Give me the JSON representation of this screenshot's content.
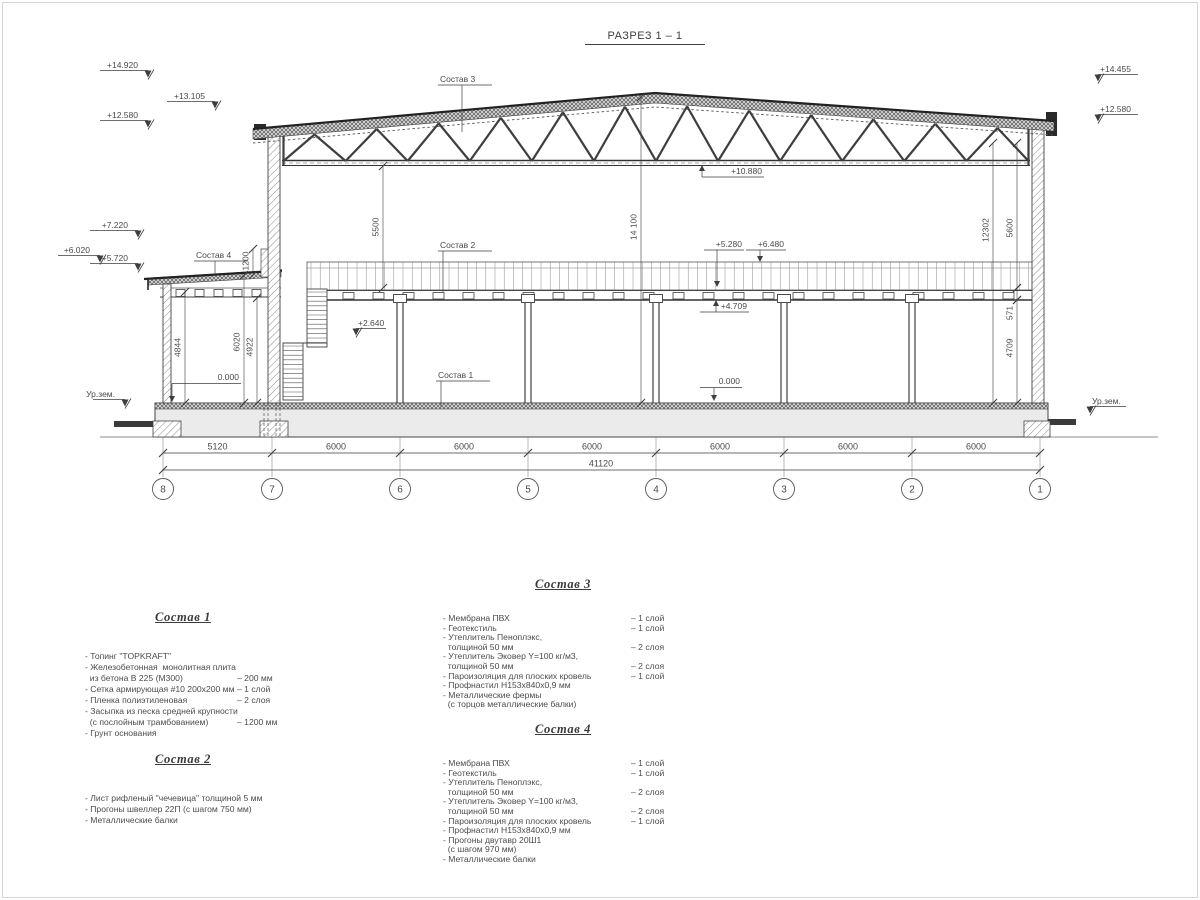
{
  "title": "РАЗРЕЗ 1 – 1",
  "marks": {
    "m14920": "+14.920",
    "m13105": "+13.105",
    "m12580l": "+12.580",
    "m7220": "+7.220",
    "m6020": "+6.020",
    "m5720": "+5.720",
    "m14455": "+14.455",
    "m12580r": "+12.580",
    "m10880": "+10.880",
    "m5280": "+5.280",
    "m6480": "+6.480",
    "m4709": "+4.709",
    "m2640": "+2.640",
    "zero1": "0.000",
    "zero2": "0.000",
    "ground_left": "Ур.зем.",
    "ground_right": "Ур.зем."
  },
  "vdims": {
    "d5500": "5500",
    "d14100": "14 100",
    "d12302": "12302",
    "d5600": "5600",
    "d571": "571",
    "d4709v": "4709",
    "d4844": "4844",
    "d6020": "6020",
    "d4922": "4922",
    "d1200": "1200"
  },
  "leaders": {
    "s1": "Состав 1",
    "s2": "Состав 2",
    "s3": "Состав 3",
    "s4": "Состав 4"
  },
  "bdims": {
    "bays": [
      "5120",
      "6000",
      "6000",
      "6000",
      "6000",
      "6000",
      "6000"
    ],
    "total": "41120"
  },
  "grid": [
    "8",
    "7",
    "6",
    "5",
    "4",
    "3",
    "2",
    "1"
  ],
  "specs": [
    {
      "title": "Состав 1",
      "items": [
        {
          "t": "- Топинг \"TOPKRAFT\"",
          "v": ""
        },
        {
          "t": "- Железобетонная  монолитная плита",
          "v": ""
        },
        {
          "t": "  из бетона В 225 (М300)",
          "v": "– 200 мм"
        },
        {
          "t": "- Сетка армирующая #10 200х200 мм",
          "v": "– 1 слой"
        },
        {
          "t": "- Пленка полиэтиленовая",
          "v": "– 2 слоя"
        },
        {
          "t": "- Засыпка из песка средней крупности",
          "v": ""
        },
        {
          "t": "  (с послойным трамбованием)",
          "v": "– 1200 мм"
        },
        {
          "t": "- Грунт основания",
          "v": ""
        }
      ]
    },
    {
      "title": "Состав 2",
      "items": [
        {
          "t": "- Лист рифленый \"чечевица\" толщиной 5 мм",
          "v": ""
        },
        {
          "t": "- Прогоны швеллер 22П (с шагом 750 мм)",
          "v": ""
        },
        {
          "t": "- Металлические балки",
          "v": ""
        }
      ]
    },
    {
      "title": "Состав 3",
      "items": [
        {
          "t": "- Мембрана ПВХ",
          "v": "– 1 слой"
        },
        {
          "t": "- Геотекстиль",
          "v": "– 1 слой"
        },
        {
          "t": "- Утеплитель Пеноплэкс,",
          "v": ""
        },
        {
          "t": "  толщиной 50 мм",
          "v": "– 2 слоя"
        },
        {
          "t": "- Утеплитель Эковер Y=100 кг/м3,",
          "v": ""
        },
        {
          "t": "  толщиной 50 мм",
          "v": "– 2 слоя"
        },
        {
          "t": "- Пароизоляция для плоских кровель",
          "v": "– 1 слой"
        },
        {
          "t": "- Профнастил Н153х840х0,9 мм",
          "v": ""
        },
        {
          "t": "- Металлические фермы",
          "v": ""
        },
        {
          "t": "  (с торцов металлические балки)",
          "v": ""
        }
      ]
    },
    {
      "title": "Состав 4",
      "items": [
        {
          "t": "- Мембрана ПВХ",
          "v": "– 1 слой"
        },
        {
          "t": "- Геотекстиль",
          "v": "– 1 слой"
        },
        {
          "t": "- Утеплитель Пеноплэкс,",
          "v": ""
        },
        {
          "t": "  толщиной 50 мм",
          "v": "– 2 слоя"
        },
        {
          "t": "- Утеплитель Эковер Y=100 кг/м3,",
          "v": ""
        },
        {
          "t": "  толщиной 50 мм",
          "v": "– 2 слоя"
        },
        {
          "t": "- Пароизоляция для плоских кровель",
          "v": "– 1 слой"
        },
        {
          "t": "- Профнастил Н153х840х0,9 мм",
          "v": ""
        },
        {
          "t": "- Прогоны двутавр 20Ш1",
          "v": ""
        },
        {
          "t": "  (с шагом 970 мм)",
          "v": ""
        },
        {
          "t": "- Металлические балки",
          "v": ""
        }
      ]
    }
  ]
}
